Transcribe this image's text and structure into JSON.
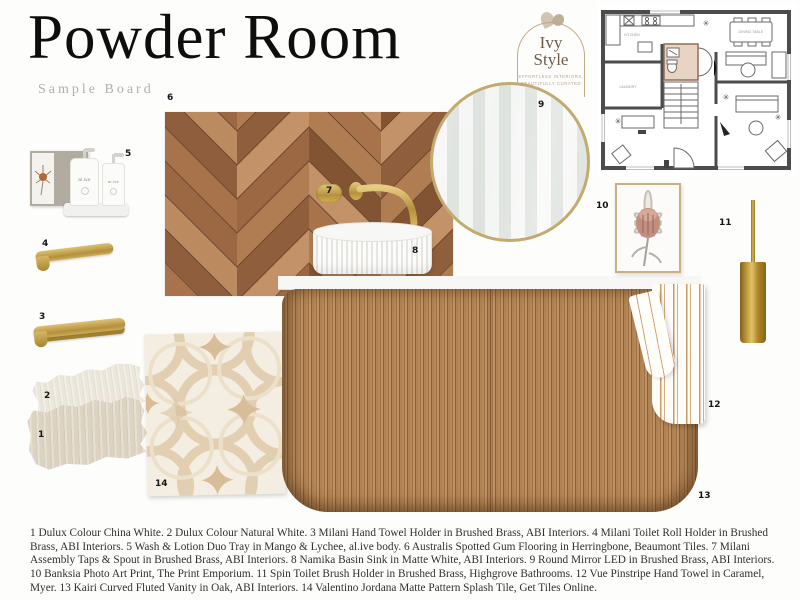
{
  "board": {
    "title": "Powder Room",
    "subtitle": "Sample Board"
  },
  "logo": {
    "name_line1": "Ivy",
    "name_line2": "Style",
    "tagline_line1": "EFFORTLESS INTERIORS,",
    "tagline_line2": "BEAUTIFULLY CURATED"
  },
  "products": {
    "bottle_label": "al.ive"
  },
  "floor_plan": {
    "labels": {
      "kitchen": "KITCHEN",
      "laundry": "LAUNDRY",
      "dining": "DINING TABLE"
    },
    "highlight_color": "#e8d4c3"
  },
  "colors": {
    "brass": "#bfa04a",
    "oak": "#ab7d4f",
    "china_white": "#ddd3c1",
    "natural_white": "#eae6da",
    "tile_beige": "#dcc3a4"
  },
  "items": [
    {
      "number": "1",
      "label": "Dulux Colour China White"
    },
    {
      "number": "2",
      "label": "Dulux Colour Natural White"
    },
    {
      "number": "3",
      "label": "Milani Hand Towel Holder in Brushed Brass, ABI Interiors"
    },
    {
      "number": "4",
      "label": "Milani Toilet Roll Holder in Brushed Brass, ABI Interiors"
    },
    {
      "number": "5",
      "label": "Wash & Lotion Duo Tray in Mango & Lychee, al.ive body"
    },
    {
      "number": "6",
      "label": "Australis Spotted Gum Flooring in Herringbone, Beaumont Tiles"
    },
    {
      "number": "7",
      "label": "Milani Assembly Taps & Spout in Brushed Brass, ABI Interiors"
    },
    {
      "number": "8",
      "label": "Namika Basin Sink in Matte White, ABI Interiors"
    },
    {
      "number": "9",
      "label": "Round Mirror LED in Brushed Brass, ABI Interiors"
    },
    {
      "number": "10",
      "label": "Banksia Photo Art Print, The Print Emporium"
    },
    {
      "number": "11",
      "label": "Spin Toilet Brush Holder in Brushed Brass, Highgrove Bathrooms"
    },
    {
      "number": "12",
      "label": "Vue Pinstripe Hand Towel in Caramel, Myer"
    },
    {
      "number": "13",
      "label": "Kairi Curved Fluted Vanity in Oak, ABI Interiors"
    },
    {
      "number": "14",
      "label": "Valentino Jordana Matte Pattern Splash Tile, Get Tiles Online"
    }
  ],
  "caption": {
    "text": "1 Dulux Colour China White. 2 Dulux Colour Natural White. 3 Milani Hand Towel Holder in Brushed Brass, ABI Interiors. 4 Milani Toilet Roll Holder in Brushed Brass, ABI Interiors. 5 Wash & Lotion Duo Tray in Mango & Lychee, al.ive body. 6 Australis Spotted Gum Flooring in Herringbone, Beaumont Tiles. 7 Milani Assembly Taps & Spout in Brushed Brass, ABI Interiors. 8 Namika Basin Sink in Matte White, ABI Interiors. 9 Round Mirror LED in Brushed Brass, ABI Interiors. 10 Banksia Photo Art Print, The Print Emporium. 11 Spin Toilet Brush Holder in Brushed Brass, Highgrove Bathrooms. 12 Vue Pinstripe Hand Towel in Caramel, Myer. 13 Kairi Curved Fluted Vanity in Oak, ABI Interiors. 14 Valentino Jordana Matte Pattern Splash Tile, Get Tiles Online."
  }
}
